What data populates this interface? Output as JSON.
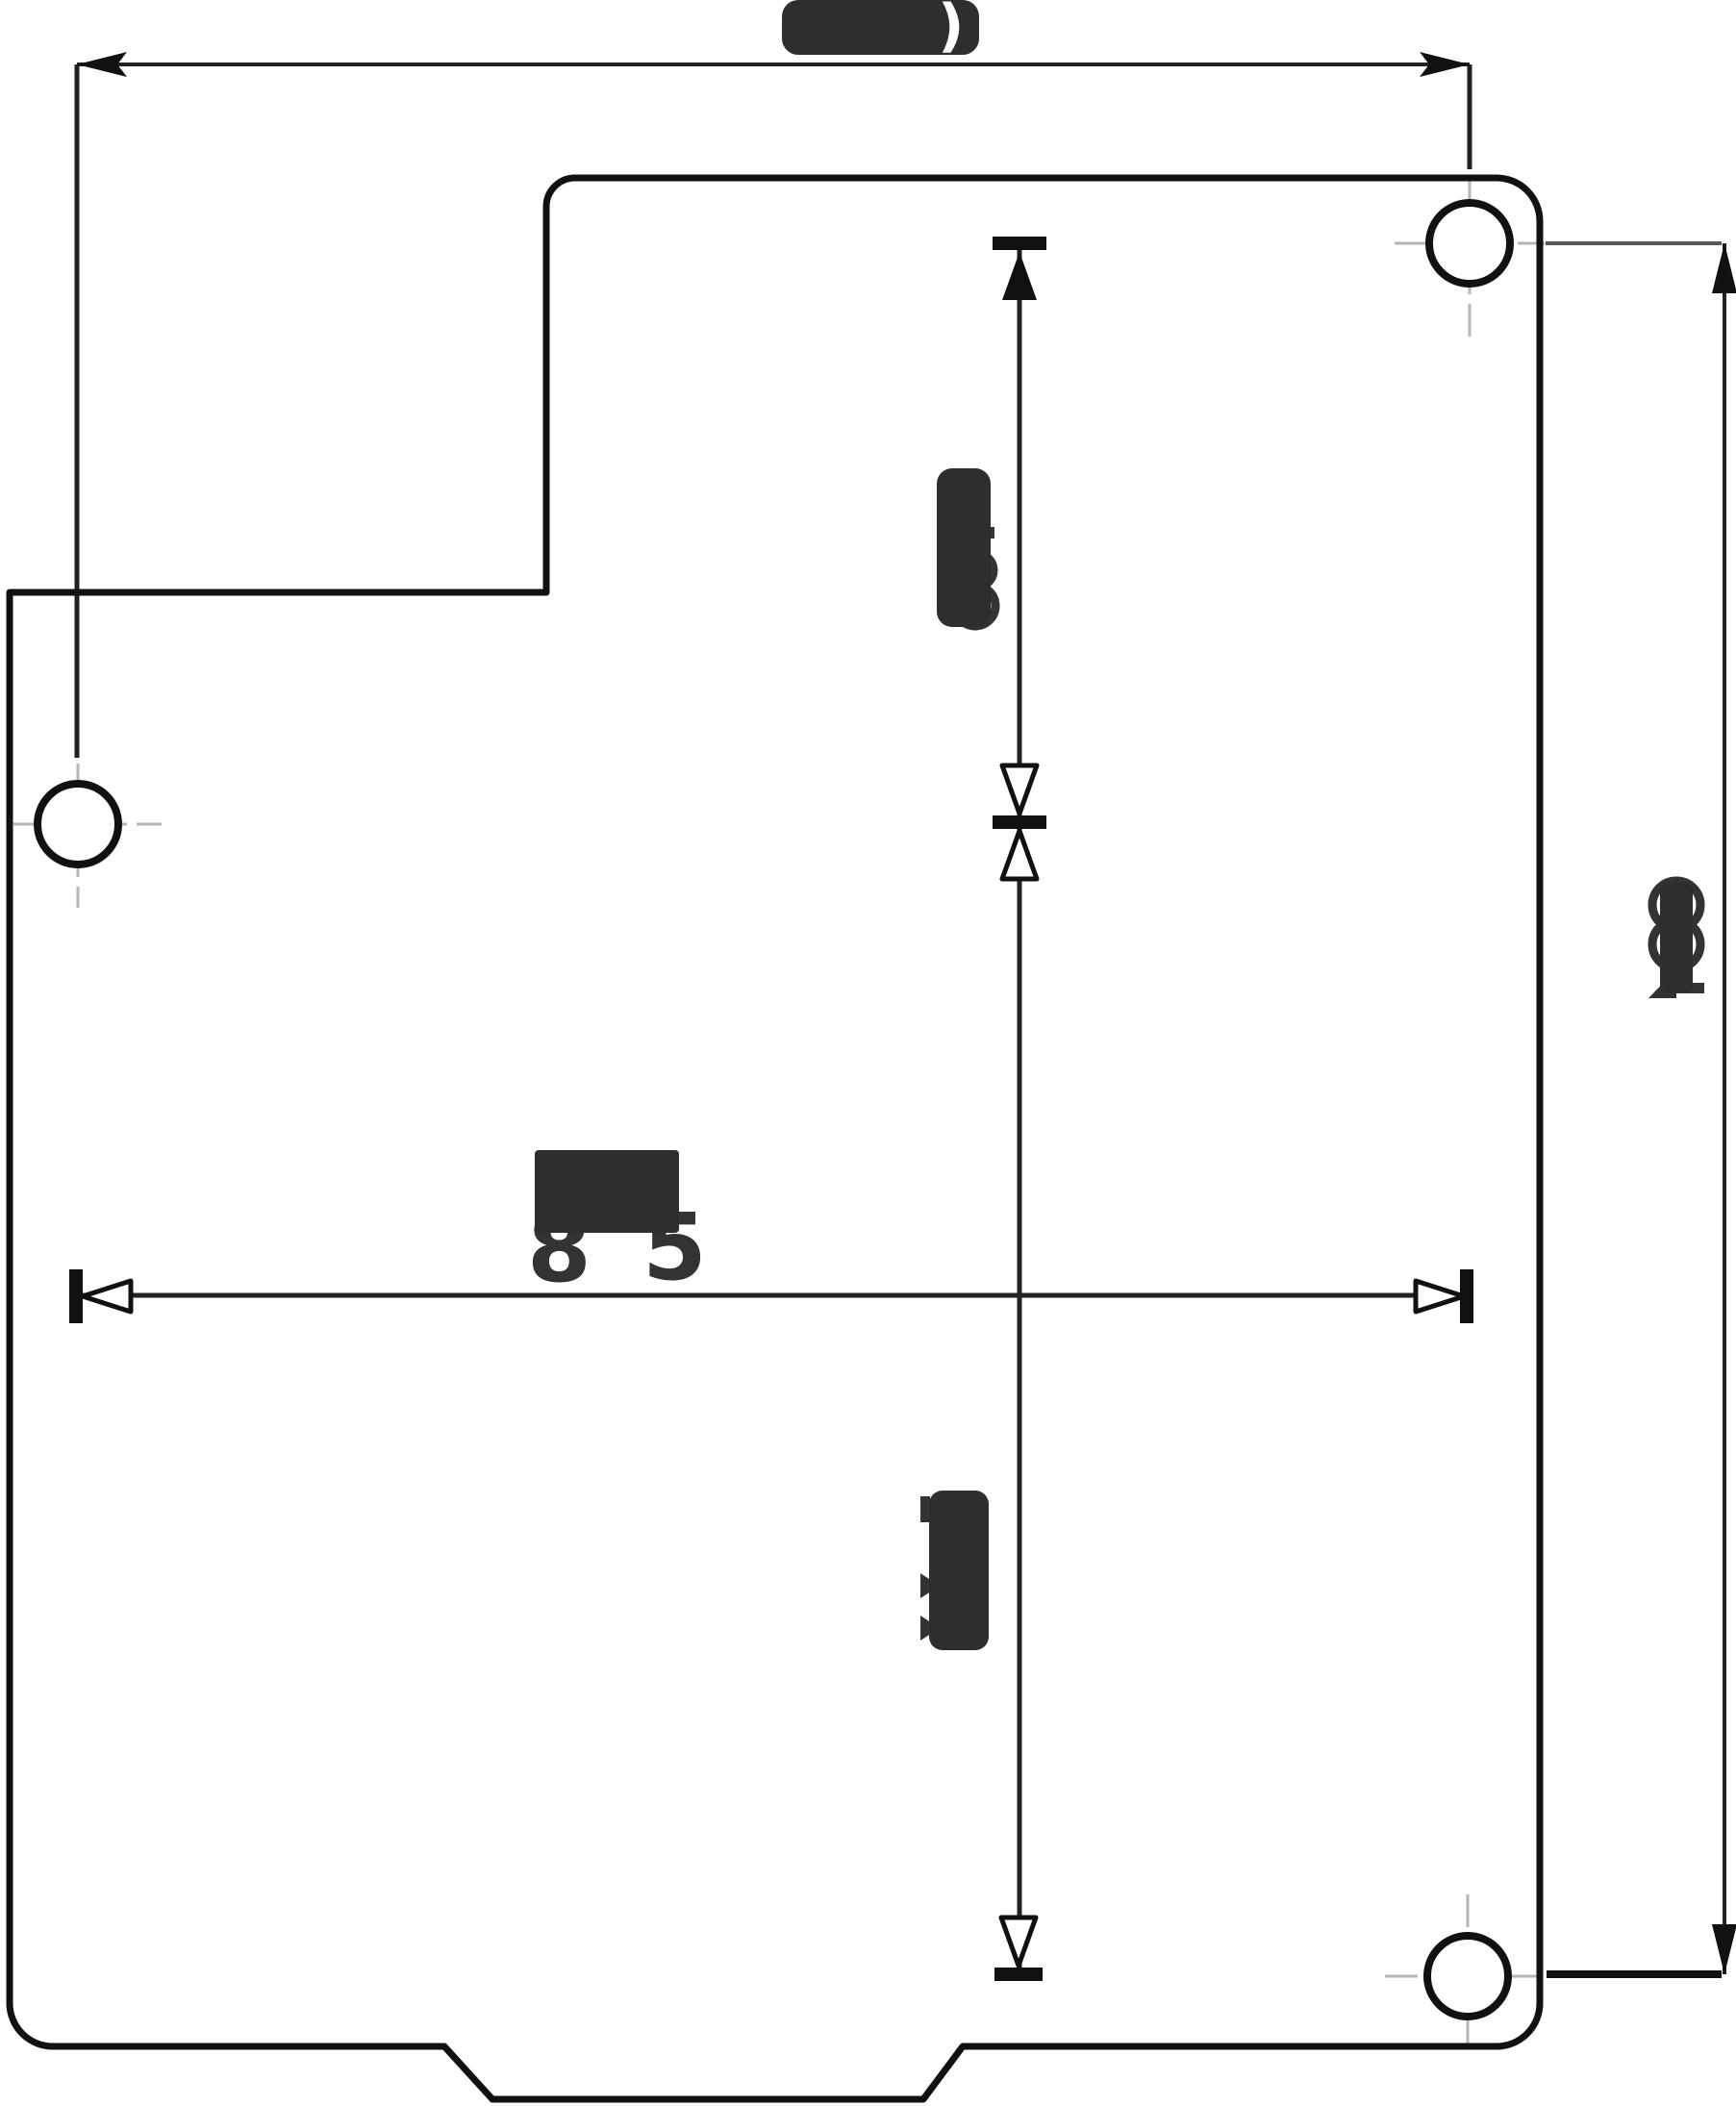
{
  "page": {
    "background_color": "#ffffff"
  },
  "drawing": {
    "stroke_color": "#111111",
    "dimension_color": "#222222",
    "centerline_color": "#b5b5b5",
    "redaction_color": "#2e2e2e",
    "hole_count": "3",
    "dimensions": {
      "top_width": {
        "status": "obscured",
        "visible_fragment": ")"
      },
      "center_width": {
        "status": "obscured",
        "fragment_left": "8",
        "fragment_right": "5"
      },
      "upper_center_height": {
        "status": "obscured",
        "visible_fragment": ""
      },
      "lower_center_height": {
        "status": "obscured",
        "visible_fragment": ""
      },
      "right_height": {
        "status": "obscured",
        "visible_fragment": ""
      }
    }
  }
}
